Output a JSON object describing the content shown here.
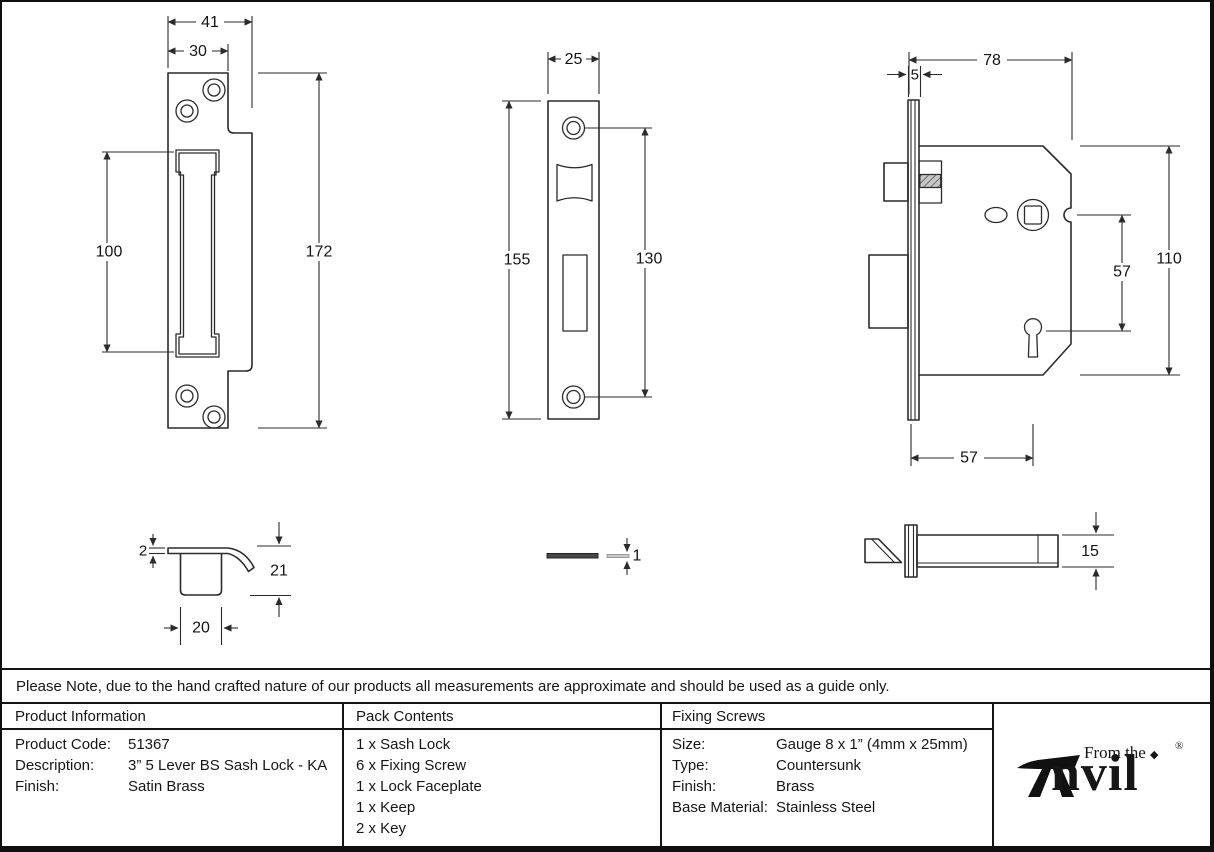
{
  "note": "Please Note, due to the hand crafted nature of our products all measurements are approximate and should be used as a guide only.",
  "drawings": {
    "keep_front_view": {
      "overall_width": "41",
      "plate_width": "30",
      "slot_height": "100",
      "overall_height": "172"
    },
    "faceplate_front_view": {
      "width": "25",
      "height": "155",
      "screw_spacing": "130"
    },
    "lock_body_view": {
      "case_depth": "78",
      "faceplate_lip": "5",
      "spindle_to_keyhole": "57",
      "case_height": "110",
      "backset": "57"
    },
    "keep_profile_view": {
      "plate_thickness": "2",
      "depth": "21",
      "box_width": "20"
    },
    "faceplate_profile_view": {
      "thickness": "1"
    },
    "lock_profile_view": {
      "case_thickness": "15"
    }
  },
  "table": {
    "product_information": {
      "header": "Product Information",
      "rows": [
        {
          "label": "Product Code:",
          "value": "51367"
        },
        {
          "label": "Description:",
          "value": "3” 5 Lever BS Sash Lock - KA"
        },
        {
          "label": "Finish:",
          "value": "Satin Brass"
        }
      ]
    },
    "pack_contents": {
      "header": "Pack Contents",
      "items": [
        "1 x Sash Lock",
        "6 x Fixing Screw",
        "1 x Lock Faceplate",
        "1 x Keep",
        "2 x Key"
      ]
    },
    "fixing_screws": {
      "header": "Fixing Screws",
      "rows": [
        {
          "label": "Size:",
          "value": "Gauge 8 x 1” (4mm x 25mm)"
        },
        {
          "label": "Type:",
          "value": "Countersunk"
        },
        {
          "label": "Finish:",
          "value": "Brass"
        },
        {
          "label": "Base Material:",
          "value": "Stainless Steel"
        }
      ]
    }
  },
  "logo": {
    "tagline": "From the",
    "brand": "Anvil",
    "brand_rest": "nvil",
    "bullet": "◆",
    "registered": "®"
  },
  "colors": {
    "line": "#2b2b2b",
    "border": "#141414",
    "background": "#ffffff"
  }
}
